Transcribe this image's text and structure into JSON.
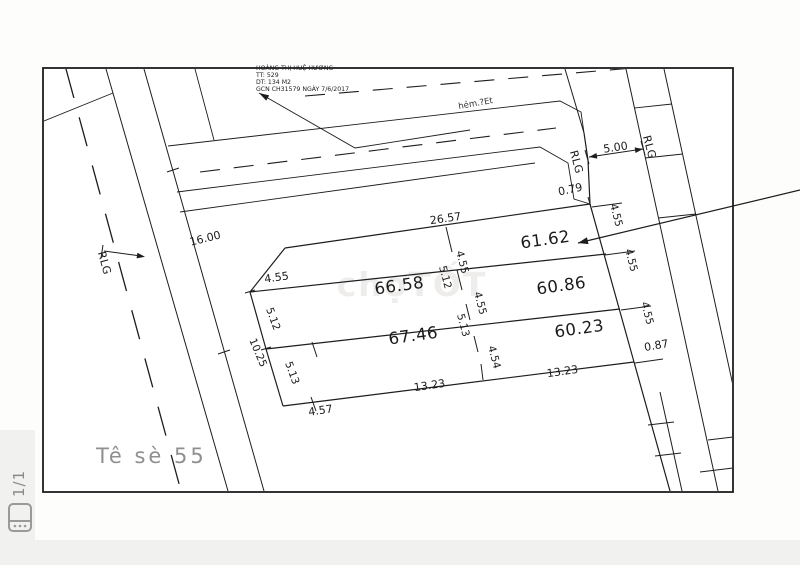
{
  "viewer": {
    "page_indicator": "1/1",
    "gallery_icon": "gallery-icon"
  },
  "map": {
    "sheet_label": "Tê sè 55",
    "watermark": "chợTỐT",
    "street_label": "hẻm.?Et",
    "road_label": "RLG",
    "owner_block": {
      "line1": "HOÀNG THỊ HUỆ HƯƠNG",
      "line2": "TT: 529",
      "line3": "DT: 134 M2",
      "line4": "GCN CH31579 NGÀY 7/6/2017"
    },
    "plots": {
      "p_6162": "61.62",
      "p_6658": "66.58",
      "p_6086": "60.86",
      "p_6746": "67.46",
      "p_6023": "60.23"
    },
    "dims": {
      "v2657": "26.57",
      "v079": "0.79",
      "v500": "5.00",
      "v1600": "16.00",
      "v1025": "10.25",
      "v455": "4.55",
      "v512": "5.12",
      "v513": "5.13",
      "v454": "4.54",
      "v457": "4.57",
      "v1323": "13.23",
      "v087": "0.87"
    }
  },
  "colors": {
    "line": "#1d1d1d",
    "muted": "#8f8f8f",
    "viewer_chrome": "#f1f1ef",
    "paper": "#ffffff"
  }
}
